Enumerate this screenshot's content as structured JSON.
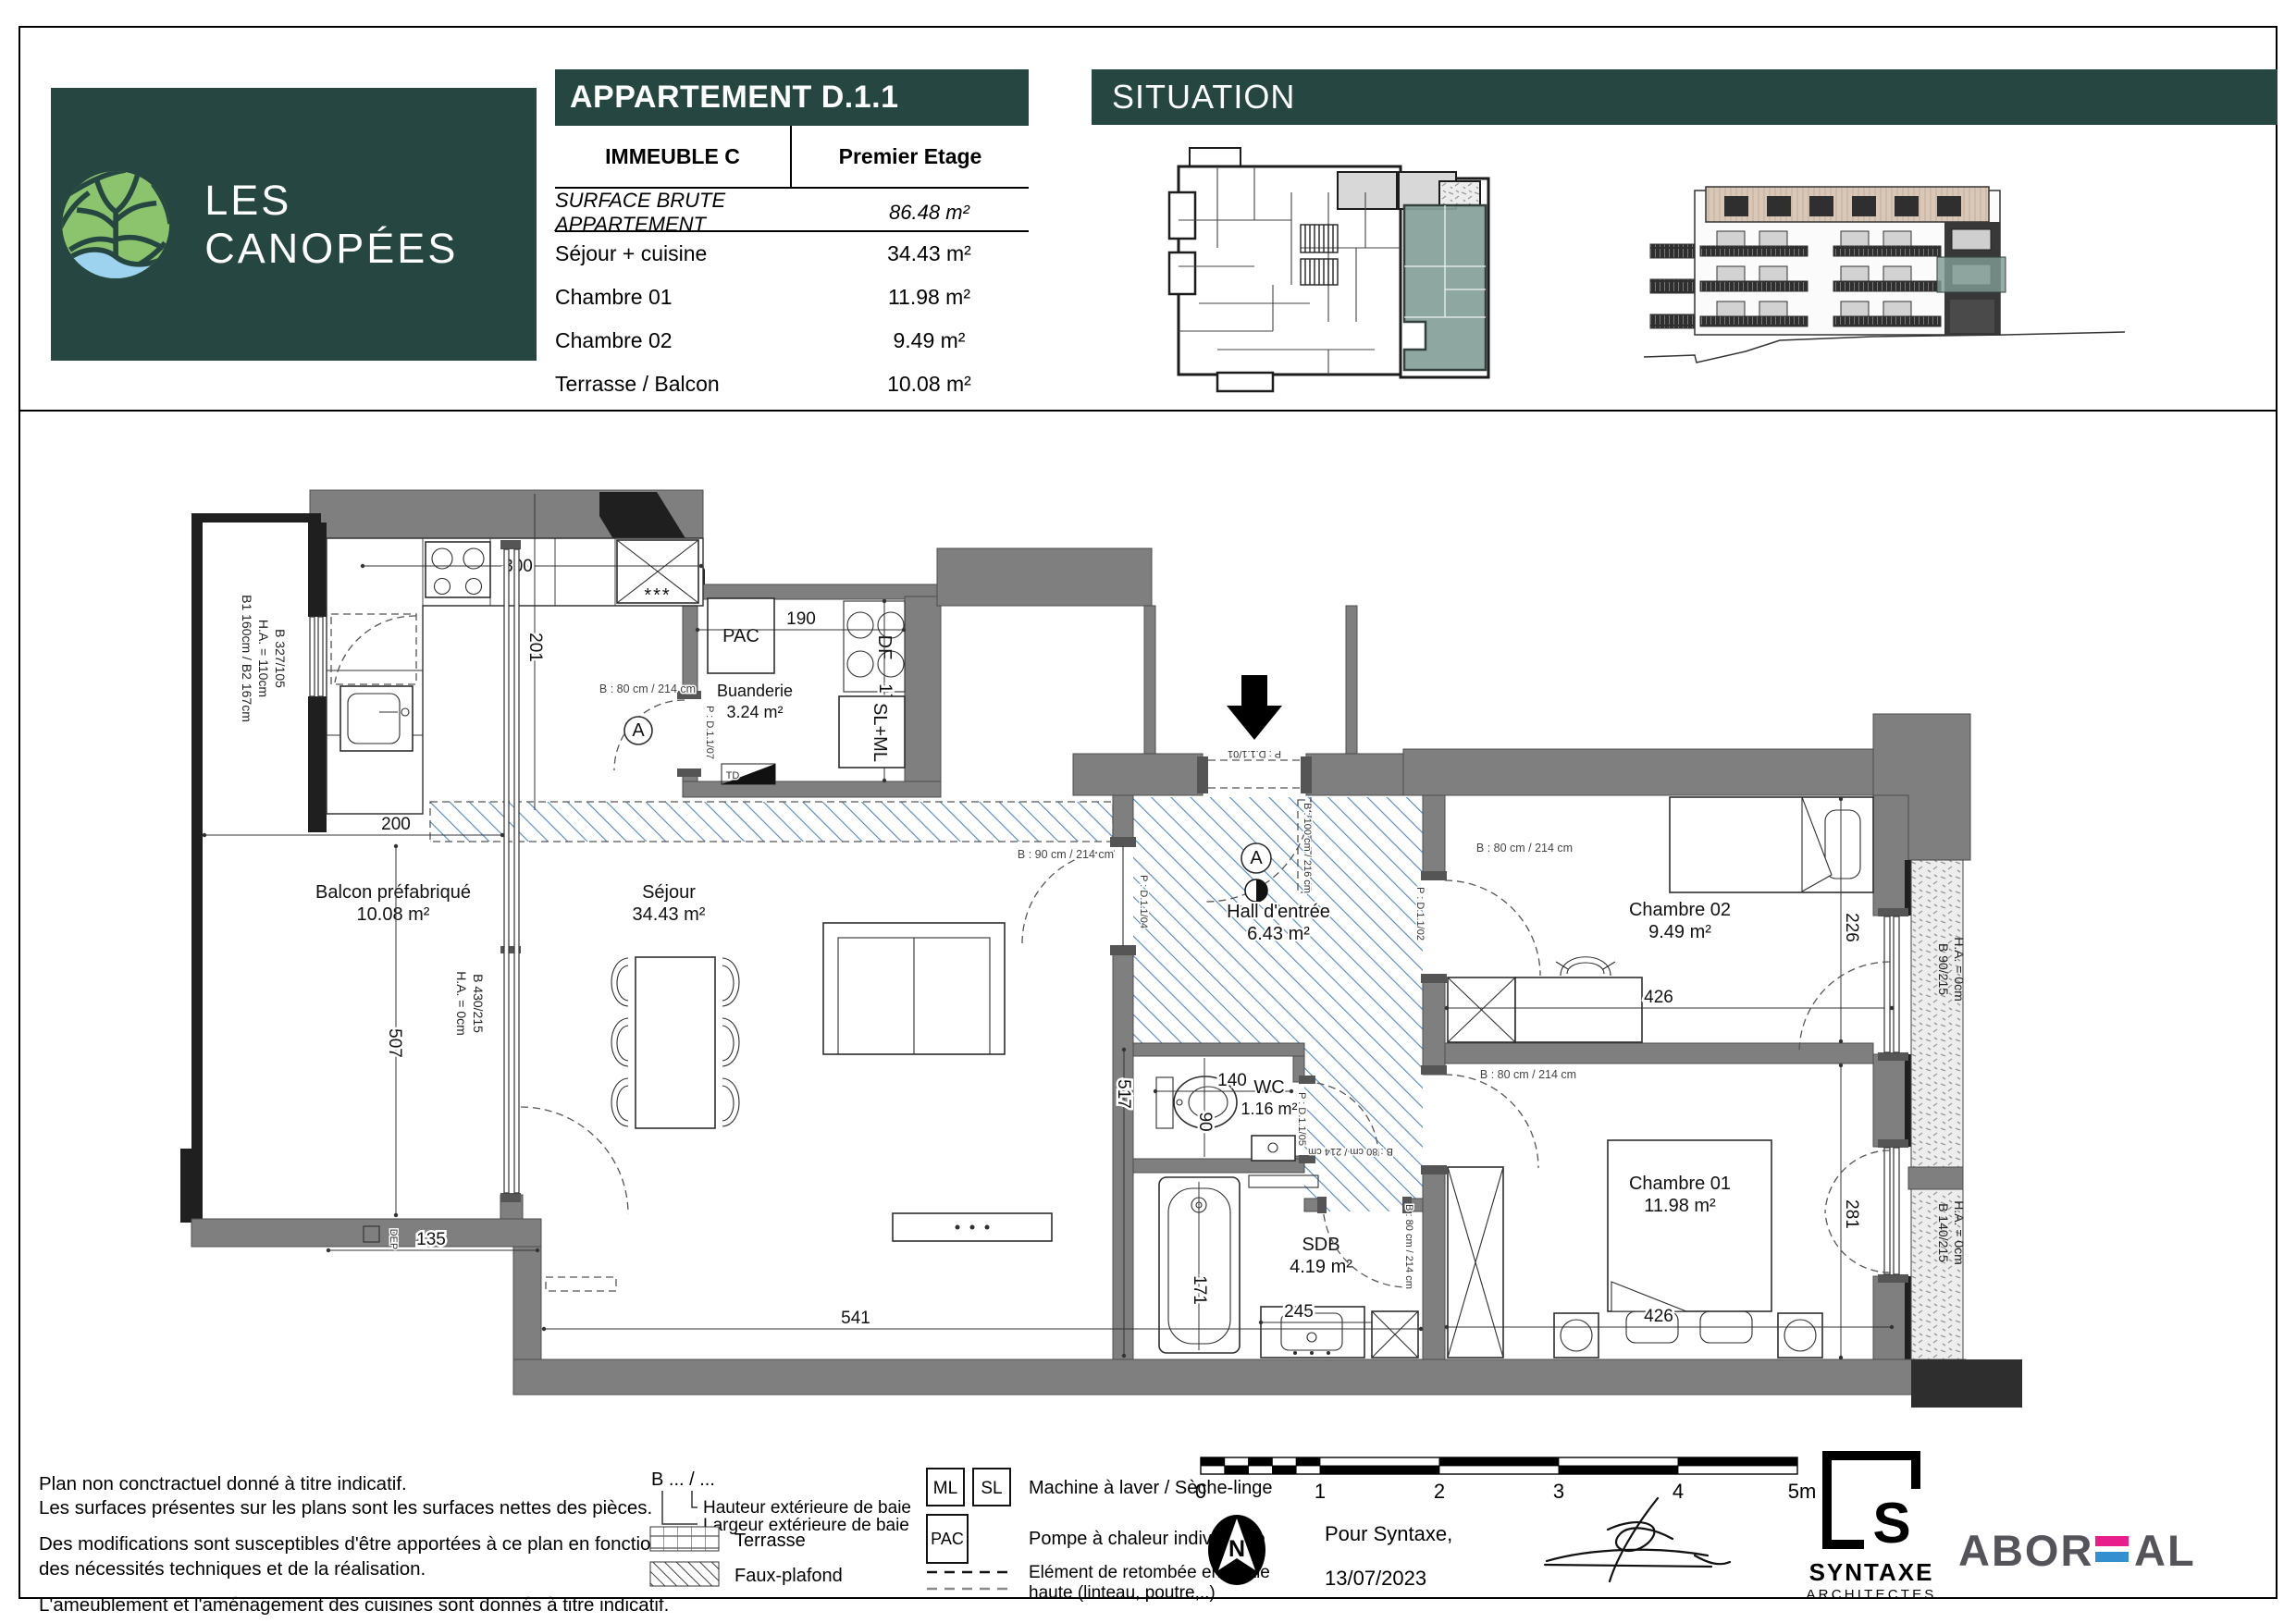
{
  "colors": {
    "brand_green": "#264741",
    "wall_gray": "#7f7f7f",
    "hatch_blue": "#4d87c7",
    "highlight_teal": "#87a09a",
    "roof_tan": "#d9c8b8",
    "accent_pink": "#e81e8d",
    "accent_blue": "#338fd0"
  },
  "header": {
    "brand": "LES CANOPÉES",
    "apartment_title": "APPARTEMENT D.1.1",
    "building": "IMMEUBLE C",
    "floor": "Premier Etage",
    "surface_label": "SURFACE BRUTE APPARTEMENT",
    "surface_value": "86.48 m²",
    "rooms": [
      {
        "label": "Séjour + cuisine",
        "value": "34.43 m²"
      },
      {
        "label": "Chambre 01",
        "value": "11.98 m²"
      },
      {
        "label": "Chambre 02",
        "value": "9.49 m²"
      },
      {
        "label": "Terrasse / Balcon",
        "value": "10.08 m²"
      }
    ],
    "situation_title": "SITUATION"
  },
  "plan": {
    "rooms": {
      "balcon": {
        "name": "Balcon préfabriqué",
        "area": "10.08 m²"
      },
      "sejour": {
        "name": "Séjour",
        "area": "34.43 m²"
      },
      "buanderie": {
        "name": "Buanderie",
        "area": "3.24 m²"
      },
      "hall": {
        "name": "Hall d'entrée",
        "area": "6.43 m²"
      },
      "wc": {
        "name": "WC",
        "area": "1.16 m²"
      },
      "sdb": {
        "name": "SDB",
        "area": "4.19 m²"
      },
      "chambre02": {
        "name": "Chambre 02",
        "area": "9.49 m²"
      },
      "chambre01": {
        "name": "Chambre 01",
        "area": "11.98 m²"
      }
    },
    "equipment": {
      "pac": "PAC",
      "df": "DF",
      "slml": "SL+ML",
      "td": "TD",
      "dep": "DEP",
      "fridge_stars": "***",
      "marker_a": "A"
    },
    "dims": {
      "d300": "300",
      "d201": "201",
      "d190": "190",
      "d170": "170",
      "d200": "200",
      "d507": "507",
      "d135": "135",
      "d541": "541",
      "d517": "517",
      "d140": "140",
      "d90": "90",
      "d171": "171",
      "d245": "245",
      "d426a": "426",
      "d226": "226",
      "d426b": "426",
      "d281": "281"
    },
    "windows": {
      "w_kitchen": [
        "B 327/105",
        "H.A. = 110cm",
        "B1 160cm / B2 167cm"
      ],
      "w_bay": [
        "B 430/215",
        "H.A. = 0cm"
      ],
      "w_ch2": [
        "B 90/215",
        "H.A. = 0cm"
      ],
      "w_ch1": [
        "B 140/215",
        "H.A. = 0cm"
      ]
    },
    "doors": {
      "entry_p": "P : D.1.1/01",
      "entry_b": "B : 100 cm / 216 cm",
      "buanderie_p": "P : D.1.1/07",
      "buanderie_b": "B : 80 cm / 214 cm",
      "sejour_p": "P : D.1.1/04",
      "sejour_b": "B : 90 cm / 214 cm",
      "wc_p": "P : D.1.1/05",
      "wc_b": "B : 80 cm / 214 cm",
      "ch2_p": "P : D.1.1/02",
      "ch2_b": "B : 80 cm / 214 cm",
      "ch1_b": "B : 80 cm / 214 cm",
      "sdb_b": "B : 80 cm / 214 cm"
    }
  },
  "footer": {
    "notes": [
      "Plan non conctractuel donné à titre indicatif.",
      "Les surfaces présentes sur les plans sont les surfaces nettes des pièces.",
      "Des modifications sont susceptibles d'être apportées à ce plan en fonction des nécessités techniques et de la réalisation.",
      "L'ameublement et l'aménagement des cuisines sont donnés à titre indicatif."
    ],
    "legend": {
      "baie_symbol": "B ... / ...",
      "baie_height": "Hauteur extérieure de baie",
      "baie_width": "Largeur extérieure de baie",
      "terrasse": "Terrasse",
      "faux_plafond": "Faux-plafond",
      "ml": "ML",
      "sl": "SL",
      "ml_sl": "Machine à laver / Sèche-linge",
      "pac": "PAC",
      "pac_label": "Pompe à chaleur individuelle",
      "retombee_1": "Elément de retombée en partie",
      "retombee_2": "haute (linteau, poutre,..)"
    },
    "scale_ticks": [
      "0",
      "1",
      "2",
      "3",
      "4",
      "5m"
    ],
    "north": "N",
    "attribution_for": "Pour Syntaxe,",
    "attribution_date": "13/07/2023",
    "logo_syntaxe_s": "S",
    "logo_syntaxe": "SYNTAXE",
    "logo_syntaxe_sub": "ARCHITECTES",
    "logo_aboreal_1": "ABOR",
    "logo_aboreal_2": "AL"
  }
}
